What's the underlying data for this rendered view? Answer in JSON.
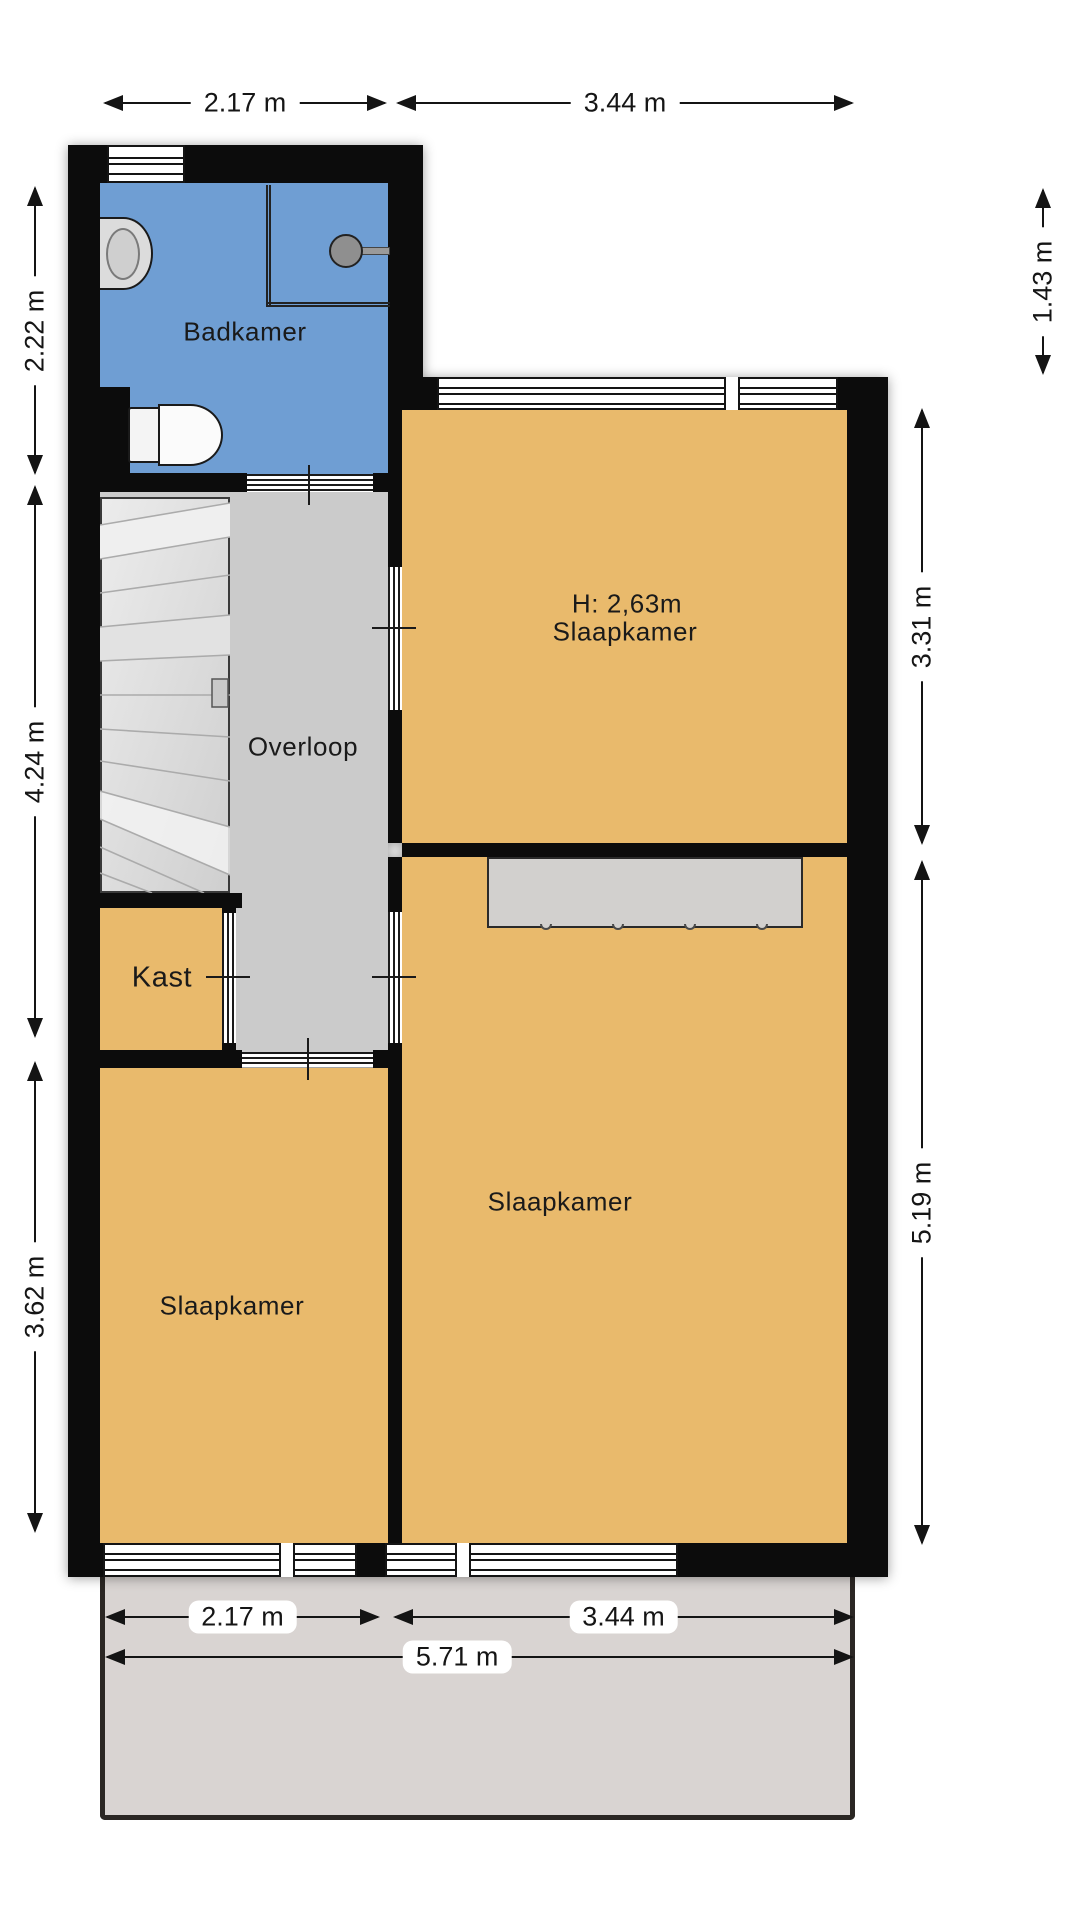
{
  "floorplan": {
    "title": "floor-plan-upper-storey",
    "rooms": {
      "badkamer": {
        "label": "Badkamer"
      },
      "overloop": {
        "label": "Overloop"
      },
      "kast": {
        "label": "Kast"
      },
      "slaapkamer_top": {
        "label": "Slaapkamer",
        "ceiling_height": "H: 2,63m"
      },
      "slaapkamer_main": {
        "label": "Slaapkamer"
      },
      "slaapkamer_left": {
        "label": "Slaapkamer"
      }
    },
    "dimensions": {
      "top_width_left": "2.17 m",
      "top_width_right": "3.44 m",
      "left_height_top": "2.22 m",
      "left_height_middle": "4.24 m",
      "left_height_bottom": "3.62 m",
      "right_height_top": "1.43 m",
      "right_height_middle": "3.31 m",
      "right_height_bottom": "5.19 m",
      "bottom_width_left": "2.17 m",
      "bottom_width_right": "3.44 m",
      "bottom_width_total": "5.71 m"
    },
    "fixtures": [
      "toilet",
      "sink",
      "shower-head",
      "stairs",
      "wardrobe"
    ],
    "colors": {
      "room_fill": "#e9ba6c",
      "bathroom_fill": "#6f9ed3",
      "hallway_fill": "#cbcbcb",
      "wall": "#0c0c0c",
      "terrace_fill": "#d9d4d2",
      "stairs_fill": "#d9d9d9",
      "wardrobe_fill": "#d2d0ce"
    }
  }
}
